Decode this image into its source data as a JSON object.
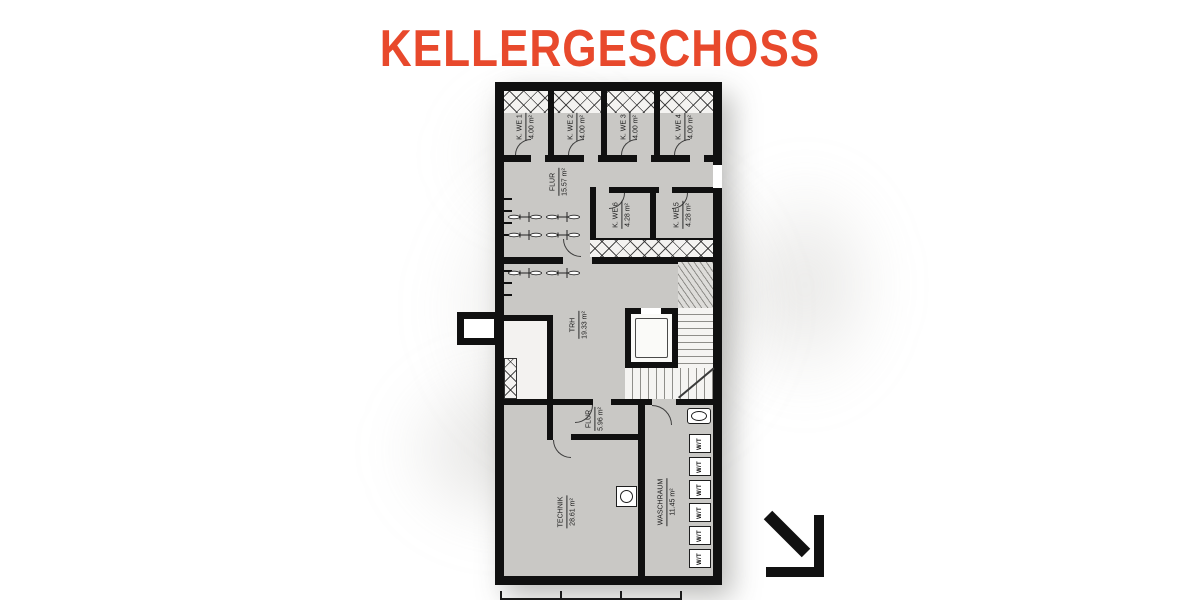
{
  "title": "KELLERGESCHOSS",
  "colors": {
    "accent": "#E8492C",
    "floor": "#c9c8c5",
    "wall": "#101010"
  },
  "rooms": {
    "kwe1": {
      "name": "K. WE 1",
      "area": "4.00 m²"
    },
    "kwe2": {
      "name": "K. WE 2",
      "area": "4.00 m²"
    },
    "kwe3": {
      "name": "K. WE 3",
      "area": "4.00 m²"
    },
    "kwe4": {
      "name": "K. WE 4",
      "area": "4.00 m²"
    },
    "flur_upper": {
      "name": "FLUR",
      "area": "15.57 m²"
    },
    "kwe6": {
      "name": "K. WE 6",
      "area": "4.28 m²"
    },
    "kwe5": {
      "name": "K. WE 5",
      "area": "4.28 m²"
    },
    "trh": {
      "name": "TRH",
      "area": "19.33 m²"
    },
    "flur_lower": {
      "name": "FLUR",
      "area": "5.96 m²"
    },
    "technik": {
      "name": "TECHNIK",
      "area": "28.61 m²"
    },
    "waschraum": {
      "name": "WASCHRAUM",
      "area": "11.45 m²"
    }
  },
  "laundry": {
    "unit_label": "W/T",
    "unit_count": 6
  }
}
